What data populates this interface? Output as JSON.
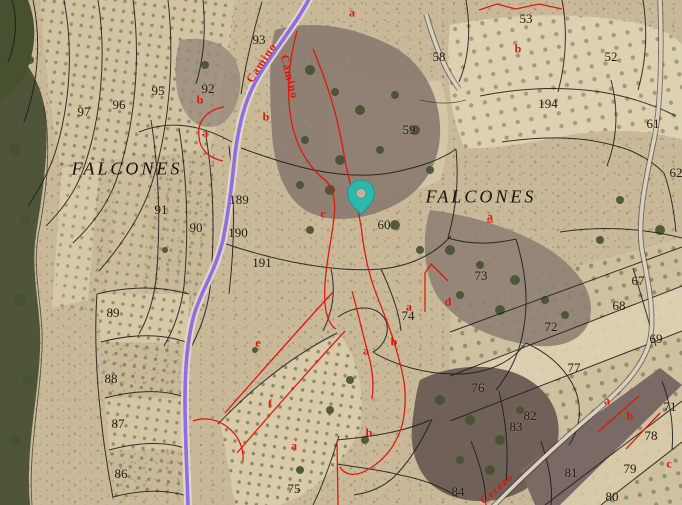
{
  "map": {
    "place_names": [
      {
        "text": "FALCONES",
        "x": 127,
        "y": 169
      },
      {
        "text": "FALCONES",
        "x": 481,
        "y": 197
      }
    ],
    "parcel_numbers": [
      {
        "n": "93",
        "x": 259,
        "y": 40
      },
      {
        "n": "97",
        "x": 84,
        "y": 112
      },
      {
        "n": "96",
        "x": 119,
        "y": 105
      },
      {
        "n": "95",
        "x": 158,
        "y": 91
      },
      {
        "n": "92",
        "x": 208,
        "y": 89
      },
      {
        "n": "53",
        "x": 526,
        "y": 19
      },
      {
        "n": "58",
        "x": 439,
        "y": 57
      },
      {
        "n": "52",
        "x": 611,
        "y": 57
      },
      {
        "n": "194",
        "x": 548,
        "y": 104
      },
      {
        "n": "61",
        "x": 653,
        "y": 124
      },
      {
        "n": "59",
        "x": 409,
        "y": 130
      },
      {
        "n": "62",
        "x": 676,
        "y": 173
      },
      {
        "n": "189",
        "x": 239,
        "y": 200
      },
      {
        "n": "91",
        "x": 161,
        "y": 210
      },
      {
        "n": "90",
        "x": 196,
        "y": 228
      },
      {
        "n": "190",
        "x": 238,
        "y": 233
      },
      {
        "n": "191",
        "x": 262,
        "y": 263
      },
      {
        "n": "60",
        "x": 384,
        "y": 225
      },
      {
        "n": "73",
        "x": 481,
        "y": 276
      },
      {
        "n": "67",
        "x": 638,
        "y": 281
      },
      {
        "n": "68",
        "x": 619,
        "y": 306
      },
      {
        "n": "89",
        "x": 113,
        "y": 313
      },
      {
        "n": "74",
        "x": 408,
        "y": 316
      },
      {
        "n": "72",
        "x": 551,
        "y": 327
      },
      {
        "n": "69",
        "x": 656,
        "y": 339
      },
      {
        "n": "77",
        "x": 574,
        "y": 368
      },
      {
        "n": "88",
        "x": 111,
        "y": 379
      },
      {
        "n": "76",
        "x": 478,
        "y": 388
      },
      {
        "n": "71",
        "x": 670,
        "y": 407
      },
      {
        "n": "82",
        "x": 530,
        "y": 416
      },
      {
        "n": "87",
        "x": 118,
        "y": 424
      },
      {
        "n": "83",
        "x": 516,
        "y": 427
      },
      {
        "n": "78",
        "x": 651,
        "y": 436
      },
      {
        "n": "79",
        "x": 630,
        "y": 469
      },
      {
        "n": "81",
        "x": 571,
        "y": 473
      },
      {
        "n": "86",
        "x": 121,
        "y": 474
      },
      {
        "n": "75",
        "x": 294,
        "y": 489
      },
      {
        "n": "84",
        "x": 458,
        "y": 492
      },
      {
        "n": "80",
        "x": 612,
        "y": 497
      }
    ],
    "subparcel_letters": [
      {
        "t": "a",
        "x": 352,
        "y": 13
      },
      {
        "t": "b",
        "x": 518,
        "y": 49
      },
      {
        "t": "b",
        "x": 200,
        "y": 100
      },
      {
        "t": "b",
        "x": 266,
        "y": 117
      },
      {
        "t": "a",
        "x": 205,
        "y": 133
      },
      {
        "t": "c",
        "x": 323,
        "y": 214
      },
      {
        "t": "a",
        "x": 490,
        "y": 217,
        "underline": true
      },
      {
        "t": "d",
        "x": 448,
        "y": 302
      },
      {
        "t": "a",
        "x": 409,
        "y": 307
      },
      {
        "t": "b",
        "x": 394,
        "y": 342
      },
      {
        "t": "e",
        "x": 258,
        "y": 343
      },
      {
        "t": "a",
        "x": 366,
        "y": 351
      },
      {
        "t": "a",
        "x": 607,
        "y": 401
      },
      {
        "t": "f",
        "x": 270,
        "y": 404
      },
      {
        "t": "b",
        "x": 630,
        "y": 416
      },
      {
        "t": "b",
        "x": 369,
        "y": 433
      },
      {
        "t": "a",
        "x": 294,
        "y": 446
      },
      {
        "t": "c",
        "x": 669,
        "y": 464
      }
    ],
    "road_labels": [
      {
        "text": "Camino",
        "x": 262,
        "y": 63,
        "rotation": -56
      },
      {
        "text": "Camino",
        "x": 289,
        "y": 77,
        "rotation": 76
      },
      {
        "text": "Cerezo",
        "x": 497,
        "y": 489,
        "rotation": -42
      }
    ],
    "marker": {
      "label": "selected-location",
      "x": 361,
      "y": 216
    }
  },
  "colors": {
    "marker_teal": "#2db8ac",
    "road_purple": "#8d6fdf",
    "parcel_line": "#1c1c1c",
    "subparcel_red": "#e01505",
    "label_black": "#1f1a12",
    "place_black": "#14120c"
  }
}
